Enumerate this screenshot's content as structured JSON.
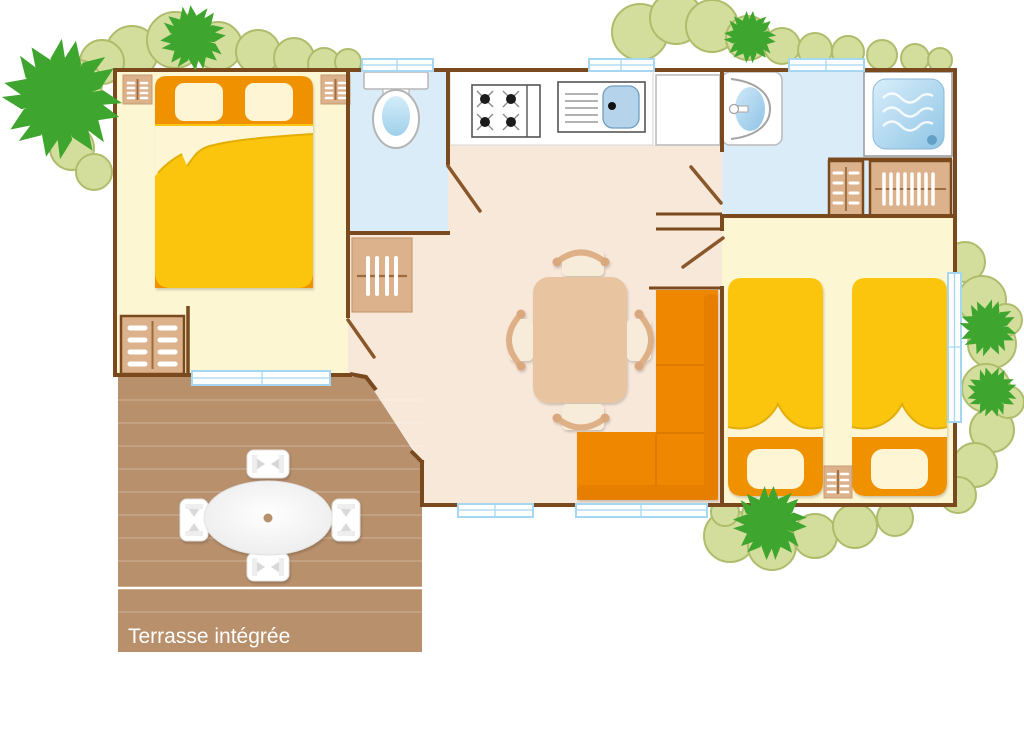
{
  "terrace": {
    "label": "Terrasse intégrée"
  },
  "palette": {
    "wall_brown": "#7a4a1e",
    "door_swing_brown": "#8a572a",
    "bedroom_floor": "#fdf6d2",
    "living_floor": "#f8e8da",
    "bathroom_floor": "#d9ecf8",
    "terrace_brown": "#b8906c",
    "bed_yellow": "#fcc508",
    "bed_orange": "#f09103",
    "sofa_orange": "#ef8703",
    "furniture_tan": "#dcb28c",
    "table_tan": "#e8c4a1",
    "pillow_cream": "#fdf5d3",
    "window_blue": "#a5d8f0",
    "sink_blue": "#b5d4ec",
    "tree_green": "#3ea52f",
    "bush_olive": "#d3de9d",
    "bush_outline": "#aebd6c",
    "label_text": "#ffffff"
  },
  "icons": {
    "tree": "pinwheel-tree-icon",
    "bush": "bush-icon",
    "stove": "stove-icon",
    "sink": "kitchen-sink-icon",
    "toilet": "toilet-icon",
    "washbasin": "washbasin-icon",
    "shower": "shower-icon"
  }
}
